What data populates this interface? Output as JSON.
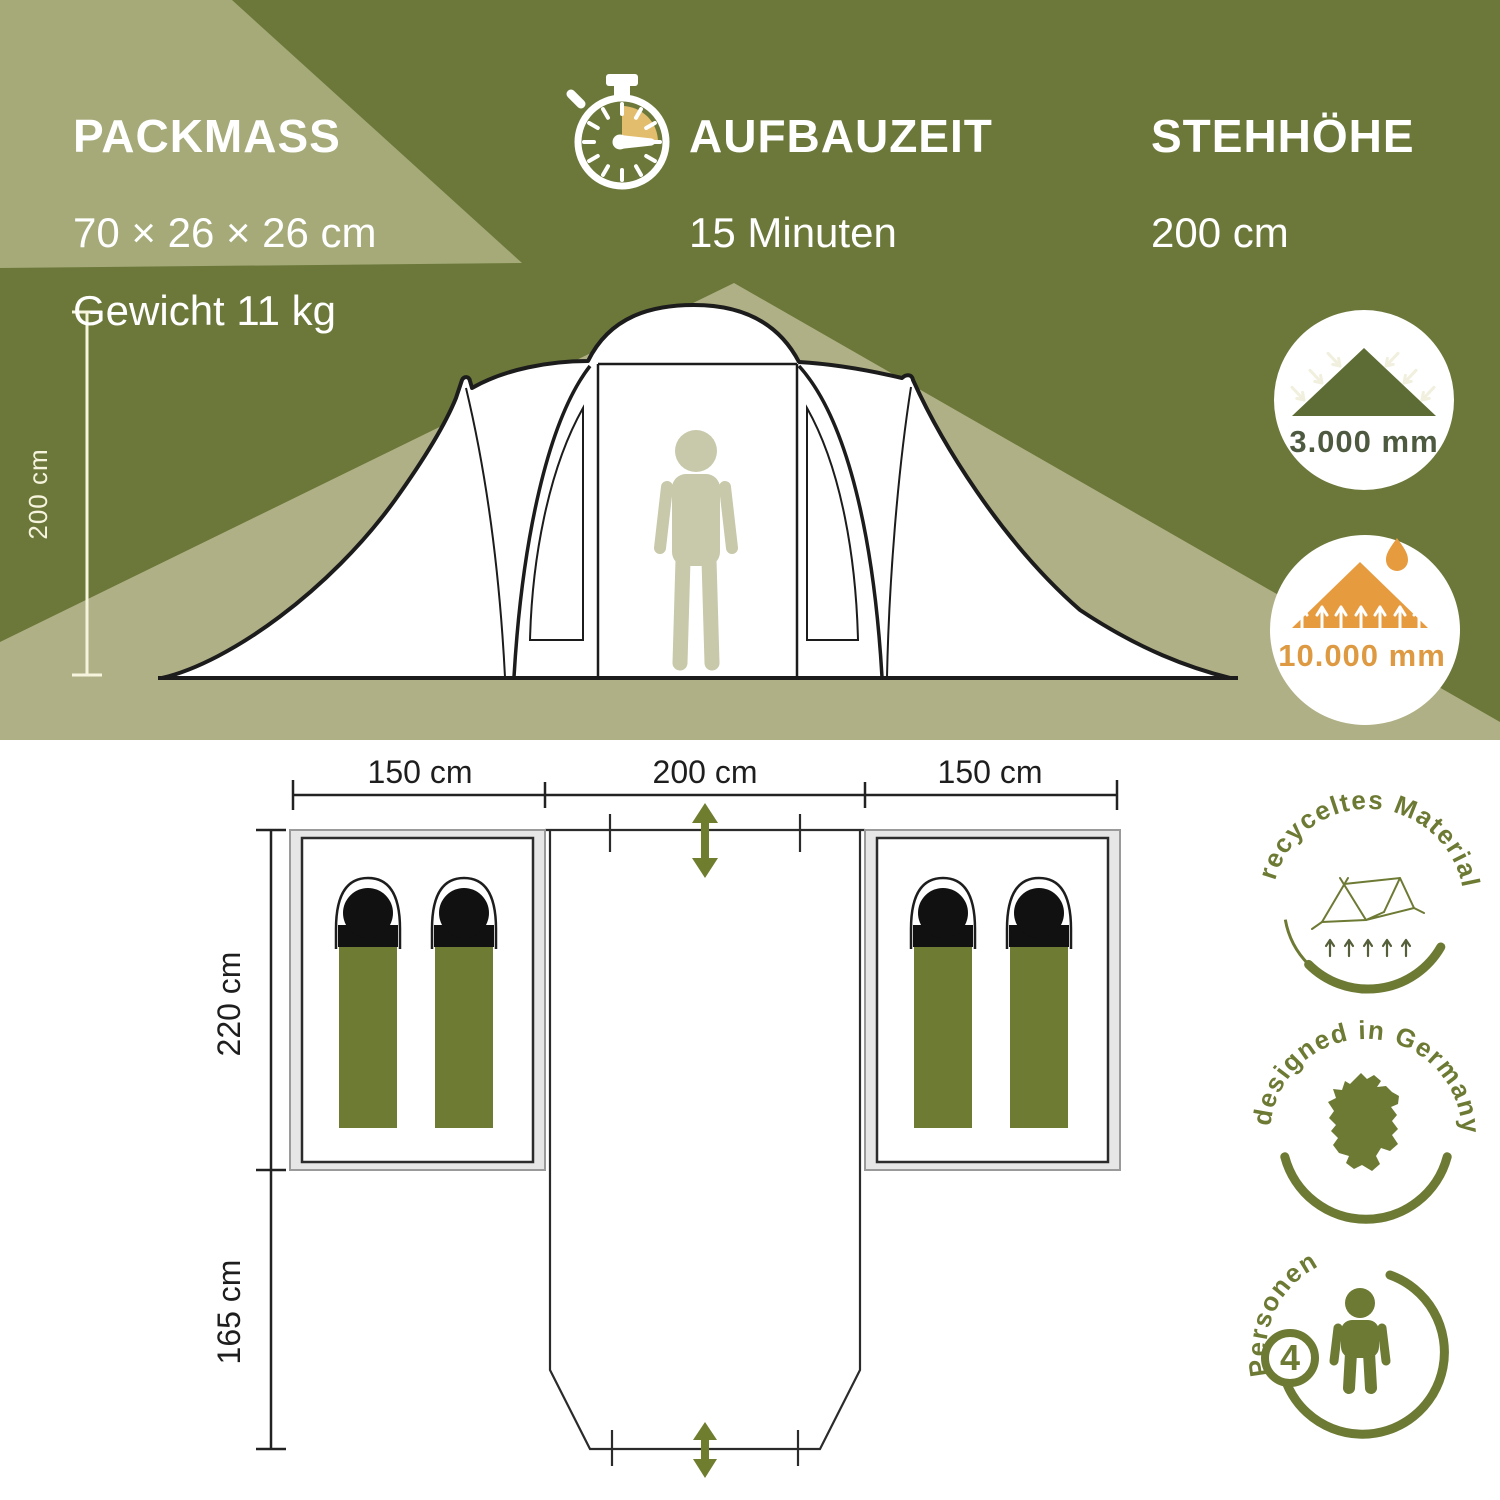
{
  "top": {
    "packmass": {
      "title": "PACKMASS",
      "dimensions": "70 × 26 × 26 cm",
      "weight": "Gewicht 11 kg"
    },
    "aufbauzeit": {
      "title": "AUFBAUZEIT",
      "value": "15 Minuten"
    },
    "stehhoehe": {
      "title": "STEHHÖHE",
      "value": "200 cm"
    },
    "tent_height_label": "200 cm",
    "water_column_tent": "3.000 mm",
    "water_column_floor": "10.000 mm"
  },
  "floorplan": {
    "width_left": "150 cm",
    "width_center": "200 cm",
    "width_right": "150 cm",
    "depth_cabin": "220 cm",
    "depth_vestibule": "165 cm"
  },
  "badges": {
    "recycled_label": "recyceltes Material",
    "designed_label": "designed in Germany",
    "persons_count": "4",
    "persons_label": "Personen"
  },
  "icons": {
    "timer": "stopwatch-icon",
    "rain": "rain-on-tent-icon",
    "groundwater": "groundsheet-water-icon",
    "recycled": "tent-sketch-icon",
    "designed": "germany-map-icon",
    "persons": "person-icon"
  },
  "colors": {
    "dark_olive": "#6b7839",
    "light_olive": "#a5aa78",
    "beam_olive": "#b0b086",
    "accent_green": "#6f7d2e",
    "badge_green": "#6d7a34",
    "orange": "#e79b3f",
    "bag_olive": "#6e7c33",
    "timer_gold": "#e3bd6e"
  }
}
